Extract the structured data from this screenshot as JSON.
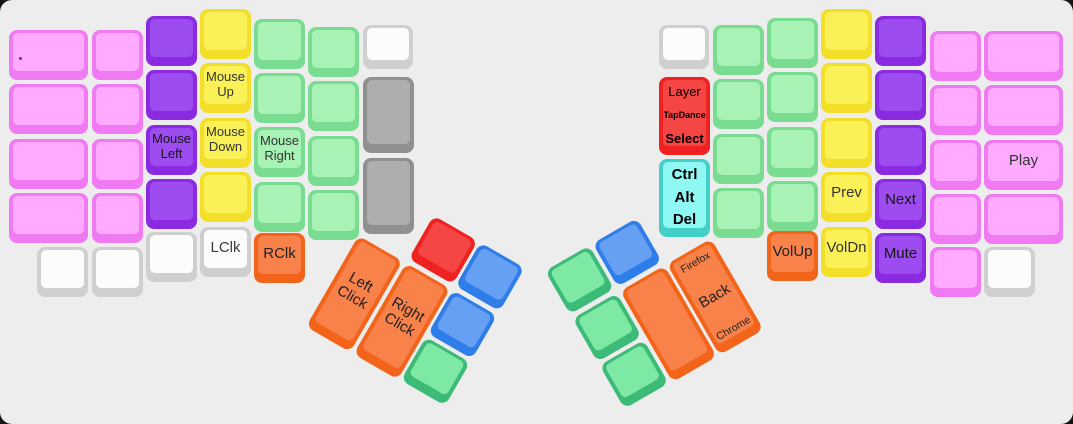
{
  "board": {
    "width": 1073,
    "height": 424,
    "background": "#ededed",
    "outer_background": "#141414",
    "corner_radius": 12,
    "description": "split-ergonomic-keyboard-keymap-view"
  },
  "palette": {
    "pink": {
      "base": "#f07af2",
      "cap": "#ffa9ff",
      "text": "#333333"
    },
    "purple": {
      "base": "#8a2be2",
      "cap": "#9d4def",
      "text": "#151515"
    },
    "yellow": {
      "base": "#f3df2a",
      "cap": "#faf158",
      "text": "#333333"
    },
    "green": {
      "base": "#79dc90",
      "cap": "#a7f2b4",
      "text": "#333333"
    },
    "white": {
      "base": "#cfcfcf",
      "cap": "#fcfcfc",
      "text": "#3c3c3c"
    },
    "gray": {
      "base": "#909090",
      "cap": "#aeaeae",
      "text": "#333333"
    },
    "orange": {
      "base": "#f26419",
      "cap": "#f8824a",
      "text": "#222222"
    },
    "red": {
      "base": "#ef2121",
      "cap": "#f54646",
      "text": "#000000"
    },
    "cyan": {
      "base": "#41cfc7",
      "cap": "#8ff8f3",
      "text": "#000000"
    },
    "blue": {
      "base": "#2e7de9",
      "cap": "#66a0f3",
      "text": "#222222"
    },
    "tgreen": {
      "base": "#3cba77",
      "cap": "#7ee9a4",
      "text": "#222222"
    }
  },
  "clusters": {
    "left": {
      "x": 386,
      "y": 188,
      "angle": 30
    },
    "right": {
      "x": 545,
      "y": 271,
      "angle": -30
    }
  },
  "keys": [
    {
      "g": "m",
      "x": 9,
      "y": 30,
      "w": 79,
      "c": "pink",
      "dot": true,
      "n": "key-tiny-dot"
    },
    {
      "g": "m",
      "x": 9,
      "y": 84,
      "w": 79,
      "c": "pink"
    },
    {
      "g": "m",
      "x": 9,
      "y": 139,
      "w": 79,
      "c": "pink"
    },
    {
      "g": "m",
      "x": 9,
      "y": 193,
      "w": 79,
      "c": "pink"
    },
    {
      "g": "m",
      "x": 92,
      "y": 30,
      "c": "pink"
    },
    {
      "g": "m",
      "x": 92,
      "y": 84,
      "c": "pink"
    },
    {
      "g": "m",
      "x": 92,
      "y": 139,
      "c": "pink"
    },
    {
      "g": "m",
      "x": 92,
      "y": 193,
      "c": "pink"
    },
    {
      "g": "m",
      "x": 146,
      "y": 16,
      "c": "purple"
    },
    {
      "g": "m",
      "x": 146,
      "y": 70,
      "c": "purple"
    },
    {
      "g": "m",
      "x": 146,
      "y": 125,
      "c": "purple",
      "l": [
        "Mouse",
        "Left"
      ],
      "n": "key-mouse-left"
    },
    {
      "g": "m",
      "x": 146,
      "y": 179,
      "c": "purple"
    },
    {
      "g": "m",
      "x": 200,
      "y": 9,
      "c": "yellow"
    },
    {
      "g": "m",
      "x": 200,
      "y": 63,
      "c": "yellow",
      "l": [
        "Mouse",
        "Up"
      ],
      "n": "key-mouse-up"
    },
    {
      "g": "m",
      "x": 200,
      "y": 118,
      "c": "yellow",
      "l": [
        "Mouse",
        "Down"
      ],
      "n": "key-mouse-down"
    },
    {
      "g": "m",
      "x": 200,
      "y": 172,
      "c": "yellow"
    },
    {
      "g": "m",
      "x": 254,
      "y": 19,
      "c": "green"
    },
    {
      "g": "m",
      "x": 254,
      "y": 73,
      "c": "green"
    },
    {
      "g": "m",
      "x": 254,
      "y": 127,
      "c": "green",
      "l": [
        "Mouse",
        "Right"
      ],
      "n": "key-mouse-right"
    },
    {
      "g": "m",
      "x": 254,
      "y": 182,
      "c": "green"
    },
    {
      "g": "m",
      "x": 308,
      "y": 27,
      "c": "green"
    },
    {
      "g": "m",
      "x": 308,
      "y": 81,
      "c": "green"
    },
    {
      "g": "m",
      "x": 308,
      "y": 136,
      "c": "green"
    },
    {
      "g": "m",
      "x": 308,
      "y": 190,
      "c": "green"
    },
    {
      "g": "m",
      "x": 363,
      "y": 25,
      "w": 50,
      "h": 44,
      "c": "white"
    },
    {
      "g": "m",
      "x": 363,
      "y": 77,
      "h": 76,
      "c": "gray"
    },
    {
      "g": "m",
      "x": 363,
      "y": 158,
      "h": 76,
      "c": "gray"
    },
    {
      "g": "m",
      "x": 37,
      "y": 247,
      "c": "white"
    },
    {
      "g": "m",
      "x": 92,
      "y": 247,
      "c": "white"
    },
    {
      "g": "m",
      "x": 146,
      "y": 232,
      "c": "white"
    },
    {
      "g": "m",
      "x": 200,
      "y": 227,
      "c": "white",
      "l": [
        "LClk"
      ],
      "fs": 15,
      "n": "key-lclk"
    },
    {
      "g": "m",
      "x": 254,
      "y": 233,
      "c": "orange",
      "l": [
        "RClk"
      ],
      "fs": 15,
      "n": "key-rclk"
    },
    {
      "g": "l",
      "x": 0,
      "y": 54.5,
      "h": 105,
      "c": "orange",
      "l": [
        "Left",
        "Click"
      ],
      "fs": 15,
      "n": "key-left-click"
    },
    {
      "g": "l",
      "x": 54.5,
      "y": 0,
      "c": "red",
      "n": "key-thumb-red"
    },
    {
      "g": "l",
      "x": 54.5,
      "y": 54.5,
      "h": 105,
      "c": "orange",
      "l": [
        "Right",
        "Click"
      ],
      "fs": 15,
      "n": "key-right-click"
    },
    {
      "g": "l",
      "x": 109,
      "y": 0,
      "c": "blue"
    },
    {
      "g": "l",
      "x": 109,
      "y": 54.5,
      "c": "blue"
    },
    {
      "g": "l",
      "x": 109,
      "y": 109,
      "c": "tgreen"
    },
    {
      "g": "m",
      "x": 659,
      "y": 25,
      "w": 50,
      "h": 44,
      "c": "white"
    },
    {
      "g": "m",
      "x": 659,
      "y": 77,
      "h": 78,
      "c": "red",
      "t3": [
        "Layer",
        "TapDance",
        "Select"
      ],
      "cls": "kd-layer",
      "n": "key-layer-tapdance-select"
    },
    {
      "g": "m",
      "x": 659,
      "y": 159,
      "h": 78,
      "c": "cyan",
      "t3": [
        "Ctrl",
        "Alt",
        "Del"
      ],
      "cls": "kd-mods",
      "n": "key-ctrl-alt-del"
    },
    {
      "g": "m",
      "x": 713,
      "y": 25,
      "c": "green"
    },
    {
      "g": "m",
      "x": 713,
      "y": 79,
      "c": "green"
    },
    {
      "g": "m",
      "x": 713,
      "y": 134,
      "c": "green"
    },
    {
      "g": "m",
      "x": 713,
      "y": 188,
      "c": "green"
    },
    {
      "g": "m",
      "x": 767,
      "y": 18,
      "c": "green"
    },
    {
      "g": "m",
      "x": 767,
      "y": 72,
      "c": "green"
    },
    {
      "g": "m",
      "x": 767,
      "y": 127,
      "c": "green"
    },
    {
      "g": "m",
      "x": 767,
      "y": 181,
      "c": "green"
    },
    {
      "g": "m",
      "x": 821,
      "y": 9,
      "c": "yellow"
    },
    {
      "g": "m",
      "x": 821,
      "y": 63,
      "c": "yellow"
    },
    {
      "g": "m",
      "x": 821,
      "y": 118,
      "c": "yellow"
    },
    {
      "g": "m",
      "x": 821,
      "y": 172,
      "c": "yellow",
      "l": [
        "Prev"
      ],
      "fs": 15,
      "n": "key-prev"
    },
    {
      "g": "m",
      "x": 875,
      "y": 16,
      "c": "purple"
    },
    {
      "g": "m",
      "x": 875,
      "y": 70,
      "c": "purple"
    },
    {
      "g": "m",
      "x": 875,
      "y": 125,
      "c": "purple"
    },
    {
      "g": "m",
      "x": 875,
      "y": 179,
      "c": "purple",
      "l": [
        "Next"
      ],
      "fs": 15,
      "n": "key-next"
    },
    {
      "g": "m",
      "x": 930,
      "y": 31,
      "c": "pink"
    },
    {
      "g": "m",
      "x": 930,
      "y": 85,
      "c": "pink"
    },
    {
      "g": "m",
      "x": 930,
      "y": 140,
      "c": "pink"
    },
    {
      "g": "m",
      "x": 930,
      "y": 194,
      "c": "pink"
    },
    {
      "g": "m",
      "x": 984,
      "y": 31,
      "w": 79,
      "c": "pink"
    },
    {
      "g": "m",
      "x": 984,
      "y": 85,
      "w": 79,
      "c": "pink"
    },
    {
      "g": "m",
      "x": 984,
      "y": 140,
      "w": 79,
      "c": "pink",
      "l": [
        "Play"
      ],
      "fs": 15,
      "n": "key-play"
    },
    {
      "g": "m",
      "x": 984,
      "y": 194,
      "w": 79,
      "c": "pink"
    },
    {
      "g": "m",
      "x": 767,
      "y": 231,
      "c": "orange",
      "l": [
        "VolUp"
      ],
      "fs": 15,
      "n": "key-volup"
    },
    {
      "g": "m",
      "x": 821,
      "y": 227,
      "c": "yellow",
      "l": [
        "VolDn"
      ],
      "fs": 15,
      "n": "key-voldn"
    },
    {
      "g": "m",
      "x": 875,
      "y": 233,
      "c": "purple",
      "l": [
        "Mute"
      ],
      "fs": 15,
      "n": "key-mute"
    },
    {
      "g": "m",
      "x": 930,
      "y": 247,
      "c": "pink"
    },
    {
      "g": "m",
      "x": 984,
      "y": 247,
      "c": "white"
    },
    {
      "g": "r",
      "x": 0,
      "y": 0,
      "c": "tgreen"
    },
    {
      "g": "r",
      "x": 0,
      "y": 54.5,
      "c": "tgreen"
    },
    {
      "g": "r",
      "x": 0,
      "y": 109,
      "c": "tgreen"
    },
    {
      "g": "r",
      "x": 54.5,
      "y": 0,
      "c": "blue"
    },
    {
      "g": "r",
      "x": 54.5,
      "y": 54.5,
      "h": 105,
      "c": "orange"
    },
    {
      "g": "r",
      "x": 109,
      "y": 54.5,
      "h": 105,
      "c": "orange",
      "t3": [
        "Firefox",
        "Back",
        "Chrome"
      ],
      "cls": "kd-browser",
      "n": "key-back-browser"
    }
  ]
}
